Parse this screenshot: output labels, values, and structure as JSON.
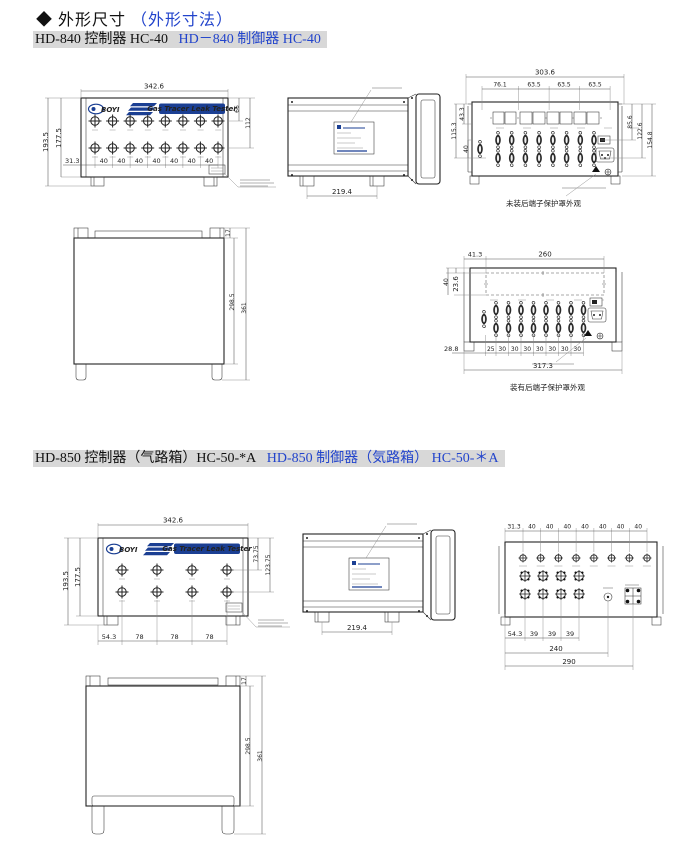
{
  "brand": {
    "logo": "BOYI",
    "tagline": "Gas Tracer Leak Tester"
  },
  "page_title": {
    "bullet": "◆",
    "cn": "外形尺寸",
    "jp": "（外形寸法）"
  },
  "hd840": {
    "heading_cn": "HD-840 控制器 HC-40",
    "heading_jp": "HD－840 制御器 HC-40",
    "front": {
      "width": "342.6",
      "height_outer": "193.5",
      "height_inner": "177.5",
      "dim_right_top": "66",
      "dim_right_mid": "112",
      "dim_left": "31.3",
      "pitches": [
        "40",
        "40",
        "40",
        "40",
        "40",
        "40",
        "40"
      ]
    },
    "side": {
      "depth": "219.4"
    },
    "rear": {
      "width_total": "303.6",
      "segs": [
        "76.1",
        "63.5",
        "63.5",
        "63.5"
      ],
      "left_height": "115.3",
      "left_top": "43.3",
      "row_pitch": "40",
      "right_dims": [
        "85.6",
        "122.6",
        "154.8"
      ],
      "caption": "未装后端子保护罩外观"
    },
    "bottom": {
      "lip": "17",
      "depth_inner": "298.5",
      "depth_total": "361"
    },
    "rear_covered": {
      "offset": "41.3",
      "cover_width": "260",
      "left_v": "40",
      "left_v2": "23.6",
      "left_offset": "28.8",
      "pitches": [
        "25",
        "30",
        "30",
        "30",
        "30",
        "30",
        "30",
        "30"
      ],
      "width_total": "317.3",
      "caption": "装有后端子保护罩外观"
    }
  },
  "hd850": {
    "heading_cn": "HD-850 控制器（气路箱）HC-50-*A",
    "heading_jp": "HD-850 制御器（気路箱） HC-50-＊A",
    "front": {
      "width": "342.6",
      "height_outer": "193.5",
      "height_inner": "177.5",
      "dim_right_top": "73.75",
      "dim_right_mid": "123.75",
      "dim_left": "54.3",
      "pitches": [
        "78",
        "78",
        "78"
      ]
    },
    "side": {
      "depth": "219.4"
    },
    "rear": {
      "left_offset": "31.3",
      "top_pitches": [
        "40",
        "40",
        "40",
        "40",
        "40",
        "40",
        "40"
      ],
      "bottom_offset": "54.3",
      "bottom_pitches": [
        "39",
        "39",
        "39"
      ],
      "dim_240": "240",
      "dim_290": "290"
    },
    "bottom": {
      "lip": "17",
      "depth_inner": "298.5",
      "depth_total": "361"
    }
  }
}
